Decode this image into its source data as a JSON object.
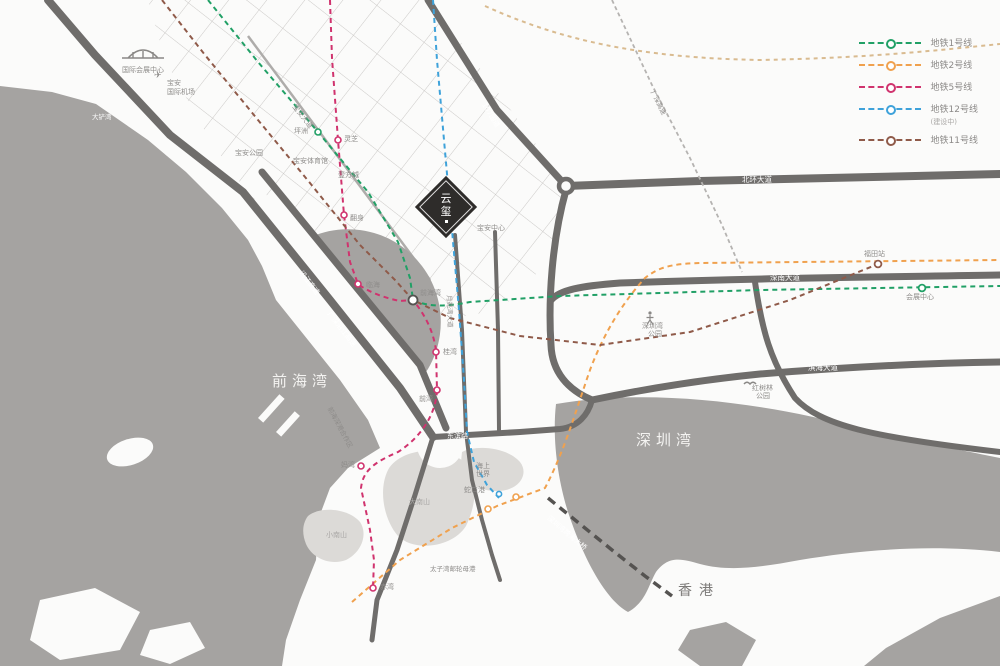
{
  "legend": {
    "items": [
      {
        "label": "地铁1号线",
        "note": "",
        "color": "#21a066"
      },
      {
        "label": "地铁2号线",
        "note": "",
        "color": "#f0a14e"
      },
      {
        "label": "地铁5号线",
        "note": "",
        "color": "#d0336e"
      },
      {
        "label": "地铁12号线",
        "note": "(建设中)",
        "color": "#3ea2da"
      },
      {
        "label": "地铁11号线",
        "note": "",
        "color": "#8f5a49"
      }
    ]
  },
  "logo": {
    "char1": "云",
    "char2": "玺"
  },
  "labels": {
    "qianhai_bay": "前海湾",
    "shenzhen_bay": "深圳湾",
    "hongkong": "香港",
    "dachanwan": "大铲湾",
    "exhibition": "国际会展中心",
    "airport1": "宝安",
    "airport2": "国际机场",
    "plane": "✈",
    "yanjiang": "沿江高速",
    "gsyj": "广深沿江高速",
    "baoan_dadao": "宝安大道",
    "g107": "107国道",
    "gs_expwy": "广深高速",
    "beihuan": "北环大道",
    "shennan": "深南大道",
    "binhai": "滨海大道",
    "dongbin": "东滨路",
    "yueliangwan": "月亮湾大道",
    "szw_bridge": "深圳湾跨海大桥",
    "hezuoqu": "前海深港合作区",
    "pingzhou": "坪洲",
    "lingzhi": "灵芝",
    "fanshen": "翻身",
    "baoan_park": "宝安公园",
    "baoan_gym": "宝安体育馆",
    "yifangcheng": "壹方城",
    "baoan_center": "宝安中心",
    "linhai": "临海",
    "qianhaiwan_st": "前海湾",
    "guiwan": "桂湾",
    "qianwan": "前湾",
    "mawan": "妈湾",
    "chiwan": "赤湾",
    "shekou_port": "蛇口港",
    "seaworld1": "海上",
    "seaworld2": "世界",
    "futian_st": "福田站",
    "huizhan_st": "会展中心",
    "taiziwan": "太子湾邮轮母港",
    "danan": "大南山",
    "xiaonan": "小南山",
    "mangrove1": "红树林",
    "mangrove2": "公园",
    "szbaypark1": "深圳湾",
    "szbaypark2": "公园"
  }
}
